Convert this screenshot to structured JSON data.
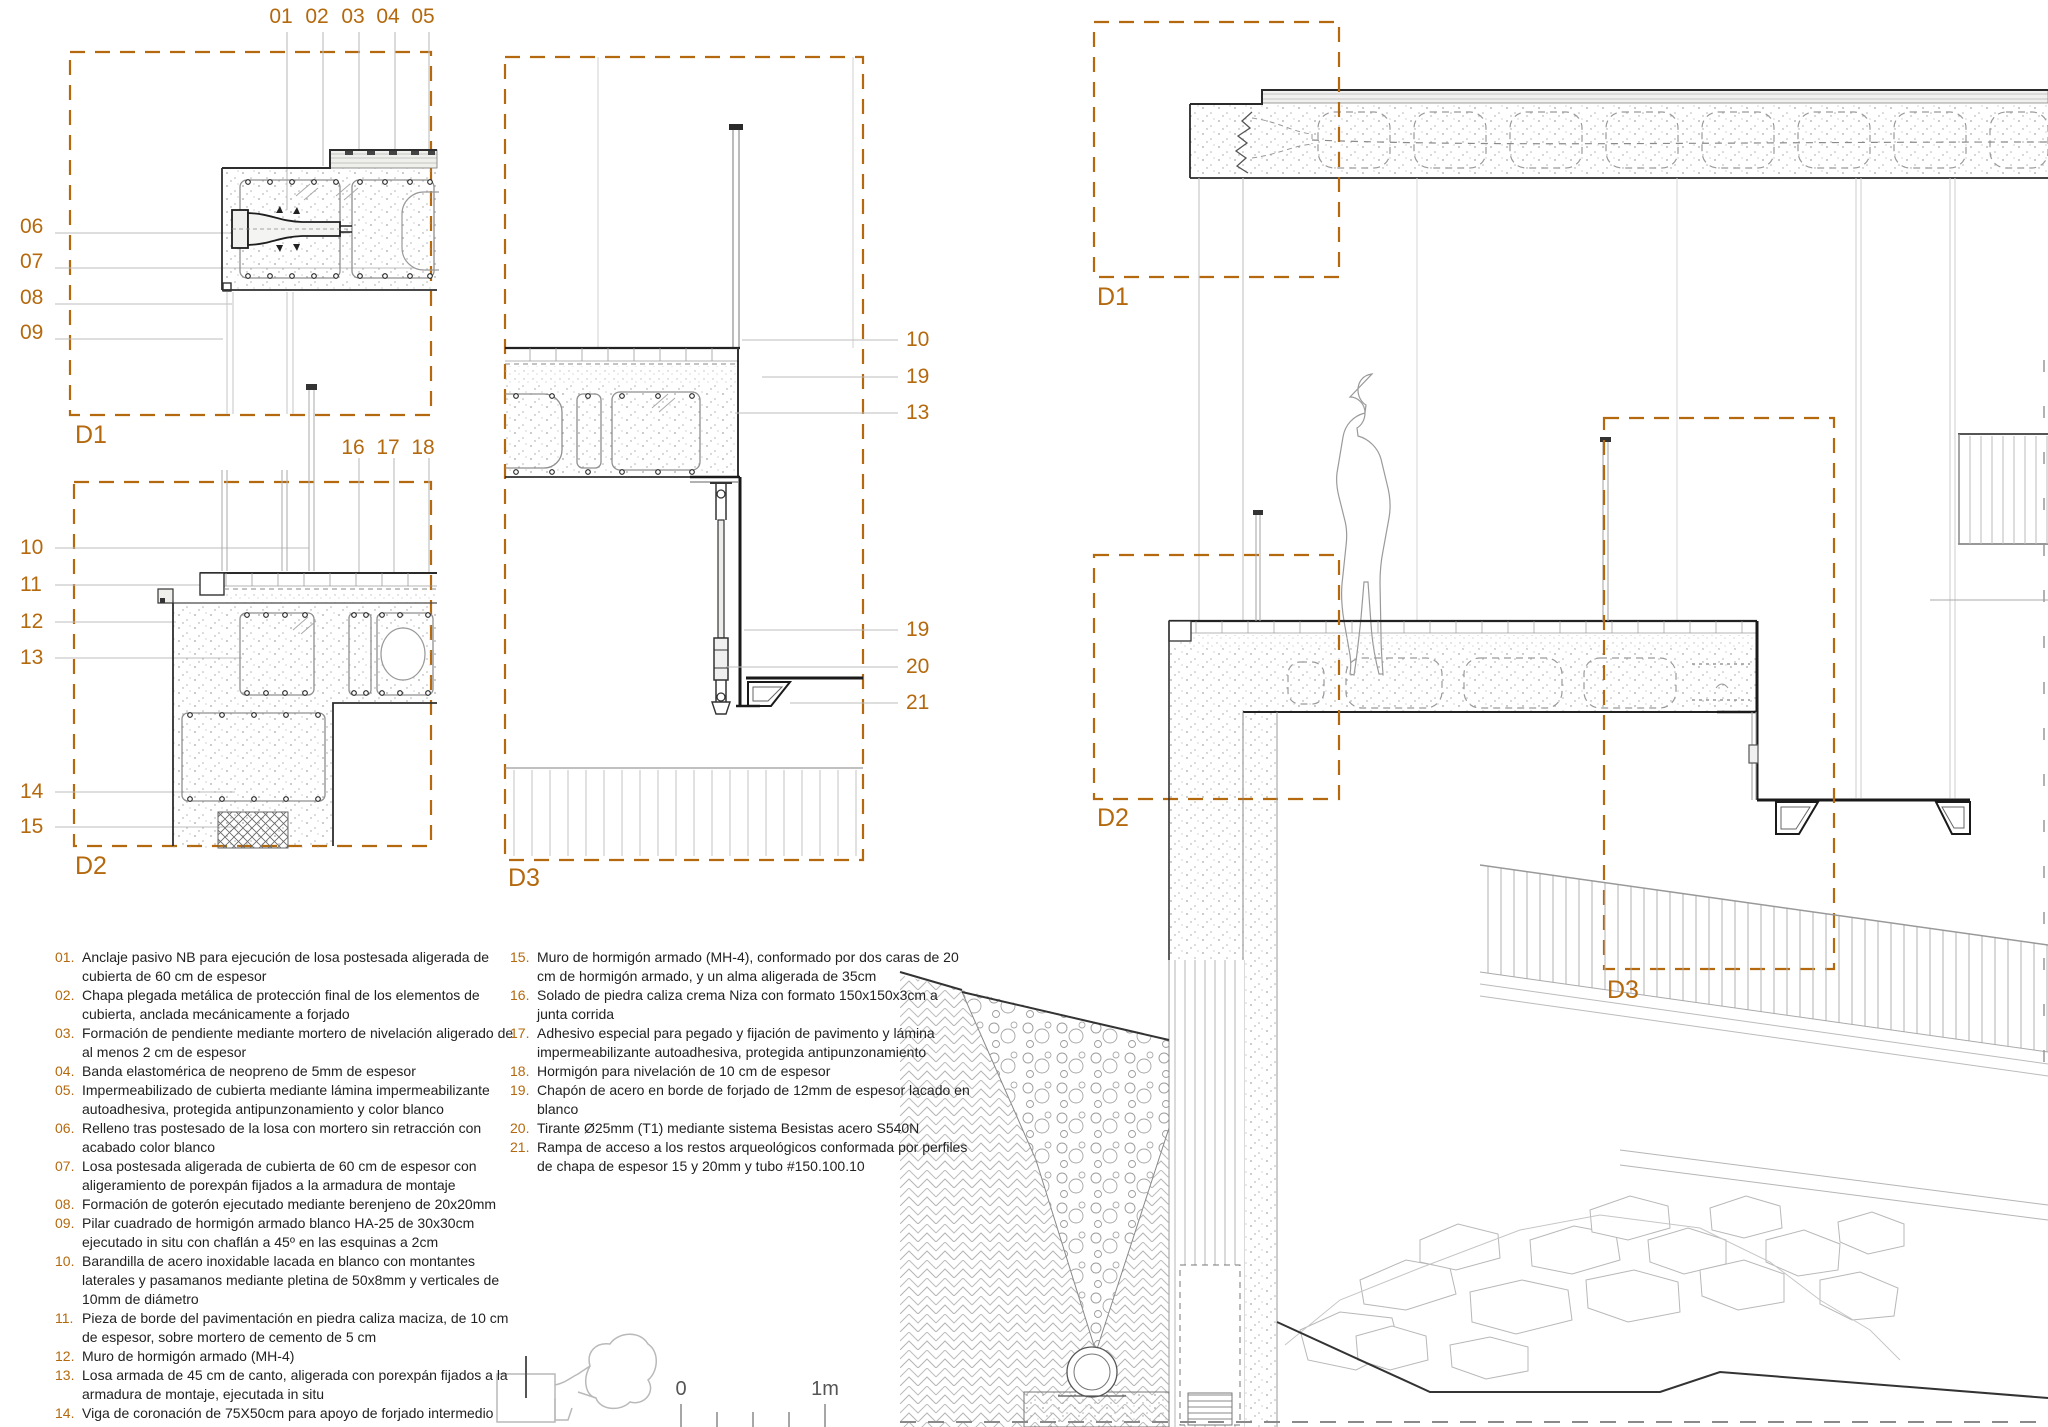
{
  "accent_color": "#B4690E",
  "line_gray": "#b5b5b5",
  "detail_views": {
    "d1": {
      "label": "D1",
      "top_callouts": [
        "01",
        "02",
        "03",
        "04",
        "05"
      ],
      "left_callouts": [
        "06",
        "07",
        "08",
        "09"
      ]
    },
    "d2": {
      "label": "D2",
      "top_callouts": [
        "16",
        "17",
        "18"
      ],
      "left_callouts": [
        "10",
        "11",
        "12",
        "13",
        "14",
        "15"
      ]
    },
    "d3": {
      "label": "D3",
      "right_upper_callouts": [
        "10",
        "19",
        "13"
      ],
      "right_lower_callouts": [
        "19",
        "20",
        "21"
      ]
    }
  },
  "section_view": {
    "d1_label": "D1",
    "d2_label": "D2",
    "d3_label": "D3"
  },
  "legend": {
    "col1": [
      {
        "num": "01.",
        "text": "Anclaje pasivo NB para ejecución de losa postesada aligerada de cubierta de 60 cm de espesor"
      },
      {
        "num": "02.",
        "text": "Chapa plegada metálica de protección final de los elementos de cubierta, anclada mecánicamente a forjado"
      },
      {
        "num": "03.",
        "text": "Formación de pendiente mediante mortero de nivelación aligerado de al menos 2 cm de espesor"
      },
      {
        "num": "04.",
        "text": "Banda elastomérica de neopreno de 5mm de espesor"
      },
      {
        "num": "05.",
        "text": "Impermeabilizado de cubierta mediante lámina impermeabilizante autoadhesiva, protegida antipunzonamiento y color blanco"
      },
      {
        "num": "06.",
        "text": "Relleno tras postesado de la losa con mortero sin retracción con acabado color blanco"
      },
      {
        "num": "07.",
        "text": "Losa postesada aligerada de cubierta de 60 cm de espesor con aligeramiento de porexpán fijados a la armadura de montaje"
      },
      {
        "num": "08.",
        "text": "Formación de goterón ejecutado mediante berenjeno de 20x20mm"
      },
      {
        "num": "09.",
        "text": "Pilar cuadrado de hormigón armado blanco HA-25 de 30x30cm ejecutado in situ con chaflán a 45º en las esquinas a 2cm"
      },
      {
        "num": "10.",
        "text": "Barandilla de acero inoxidable lacada en blanco con montantes laterales y pasamanos mediante pletina de 50x8mm y verticales de 10mm de diámetro"
      },
      {
        "num": "11.",
        "text": "Pieza de borde del pavimentación en piedra caliza maciza, de 10 cm de espesor, sobre mortero de cemento de 5 cm"
      },
      {
        "num": "12.",
        "text": "Muro de hormigón armado (MH-4)"
      },
      {
        "num": "13.",
        "text": "Losa armada de 45 cm de canto, aligerada con porexpán fijados a la armadura de montaje, ejecutada in situ"
      },
      {
        "num": "14.",
        "text": "Viga de coronación de 75X50cm para apoyo de forjado intermedio"
      }
    ],
    "col2": [
      {
        "num": "15.",
        "text": "Muro de hormigón armado (MH-4), conformado por dos caras de 20 cm de hormigón armado, y un alma aligerada de 35cm"
      },
      {
        "num": "16.",
        "text": "Solado de piedra caliza crema Niza con formato 150x150x3cm a junta corrida"
      },
      {
        "num": "17.",
        "text": "Adhesivo especial para pegado y fijación de pavimento y lámina impermeabilizante autoadhesiva, protegida antipunzonamiento"
      },
      {
        "num": "18.",
        "text": "Hormigón para nivelación de 10 cm de espesor"
      },
      {
        "num": "19.",
        "text": "Chapón de acero en borde de forjado de 12mm de espesor lacado en blanco"
      },
      {
        "num": "20.",
        "text": "Tirante Ø25mm (T1) mediante sistema Besistas acero S540N"
      },
      {
        "num": "21.",
        "text": "Rampa de acceso a los restos arqueológicos conformada por perfiles de chapa de espesor 15 y 20mm y tubo #150.100.10"
      }
    ]
  },
  "scale_bar": {
    "start": "0",
    "end": "1m"
  }
}
